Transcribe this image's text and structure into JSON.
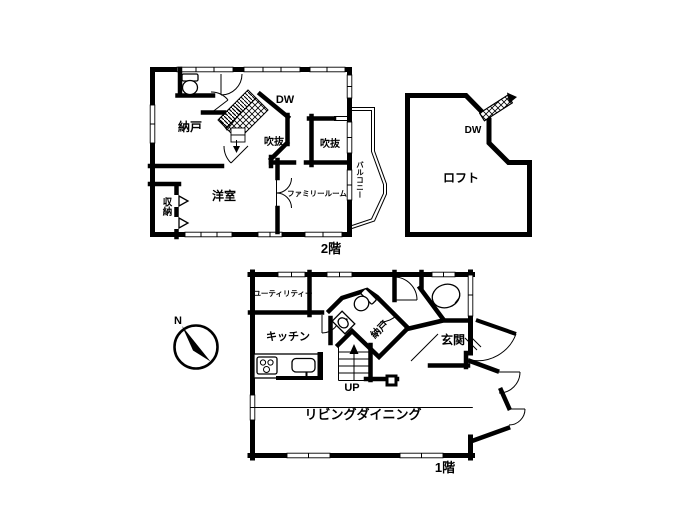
{
  "floor2": {
    "name": "2階",
    "stairs_label": "DW",
    "rooms": {
      "nando": "納戸",
      "fukinuke_a": "吹抜",
      "fukinuke_b": "吹抜",
      "yoshitsu": "洋室",
      "family_room": "ファミリールーム",
      "shuno": "収納",
      "balcony": "バルコニー"
    }
  },
  "loft": {
    "name": "ロフト",
    "ladder_label": "DW"
  },
  "floor1": {
    "name": "1階",
    "stairs_label": "UP",
    "rooms": {
      "utility": "ユーティリティー",
      "kitchen": "キッチン",
      "nando": "納戸",
      "genkan": "玄関",
      "living_dining": "リビングダイニング"
    }
  },
  "compass": {
    "north": "N"
  },
  "colors": {
    "wall": "#000000",
    "background": "#ffffff"
  }
}
